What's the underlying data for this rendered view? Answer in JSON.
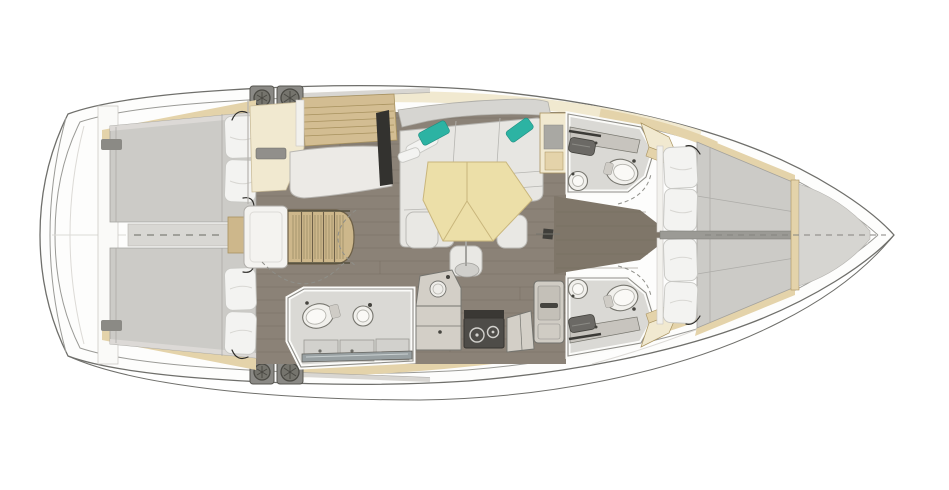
{
  "scene": {
    "label": "sailing-yacht-interior-floor-plan",
    "view": "top-down",
    "bow_direction": "right",
    "background": "#ffffff"
  },
  "colors": {
    "hull_line": "#6f6f6b",
    "hull_inner": "#9a9a96",
    "floor": "#8b8277",
    "floor_seam": "#746c61",
    "corridor": "#7f7669",
    "walkway": "#d8d7d3",
    "mattress": "#cccbc7",
    "mattress_seam": "#adaca8",
    "pillow": "#f3f3f1",
    "pillow_line": "#c8c8c4",
    "wood": "#e4d3aa",
    "wood_dark": "#cdb78b",
    "cream": "#f1e9d0",
    "table_wood": "#ecdfa8",
    "table_seam": "#c9b67c",
    "sofa": "#e7e6e2",
    "sofa_back": "#d6d5d1",
    "sofa_seam": "#b7b6b2",
    "teal": "#2cb3a3",
    "counter": "#d3cfc7",
    "counter_line": "#74746f",
    "stove": "#4e4c48",
    "stove_dark": "#363430",
    "head_floor": "#dad9d5",
    "fixture": "#f1f0ec",
    "fixture_line": "#77766f",
    "sink_dark": "#6b6965",
    "glass": "#98a0a2",
    "plate": "#8a8985",
    "plate_dark": "#56554f",
    "tv_dark": "#33322f",
    "dash": "#8f8f89",
    "white_wall": "#fafaf8"
  },
  "layout_summary": {
    "cabins": 4,
    "heads": 3,
    "salon_tables": 1,
    "winches": 4
  },
  "rooms": [
    {
      "id": "aft-deck",
      "label": "Aft deck / transom",
      "furniture": [
        "rounded transom platform",
        "centerline"
      ]
    },
    {
      "id": "aft-cabin-port",
      "label": "Aft cabin (port)",
      "furniture": [
        "double berth",
        "two pillows",
        "hull shelf",
        "reading light",
        "vent"
      ]
    },
    {
      "id": "aft-cabin-starboard",
      "label": "Aft cabin (starboard)",
      "furniture": [
        "double berth",
        "two pillows",
        "hull shelf",
        "reading light",
        "vent"
      ]
    },
    {
      "id": "companionway",
      "label": "Companionway",
      "furniture": [
        "wooden steps",
        "engine box",
        "walkway between aft berths"
      ]
    },
    {
      "id": "nav-station",
      "label": "Nav station (port)",
      "furniture": [
        "chart table",
        "nav seat",
        "instrument locker",
        "tv screen",
        "vent"
      ]
    },
    {
      "id": "saloon",
      "label": "Saloon (port)",
      "furniture": [
        "l-shaped sofa",
        "white bolster",
        "teal throw pillow left",
        "teal throw pillow right",
        "folding hexagonal table",
        "three stools",
        "table pedestal",
        "end cabinet"
      ]
    },
    {
      "id": "galley",
      "label": "Galley (starboard)",
      "furniture": [
        "round sink unit",
        "lower counter",
        "two-burner stove",
        "side counter",
        "refrigerator"
      ]
    },
    {
      "id": "day-head",
      "label": "Day head with shower (starboard)",
      "furniture": [
        "toilet",
        "round washbasin",
        "shower pans",
        "glass shower screen"
      ]
    },
    {
      "id": "head-forward-port",
      "label": "Forward head (port)",
      "furniture": [
        "vanity counter",
        "rectangular sink",
        "towel rail",
        "toilet",
        "round washbasin"
      ]
    },
    {
      "id": "head-forward-starboard",
      "label": "Forward head (starboard)",
      "furniture": [
        "vanity counter",
        "rectangular sink",
        "towel rail",
        "toilet",
        "round washbasin"
      ]
    },
    {
      "id": "forward-cabin-port",
      "label": "Forward cabin (port)",
      "furniture": [
        "berth mattress",
        "two pillows",
        "wardrobe",
        "hull trim"
      ]
    },
    {
      "id": "forward-cabin-starboard",
      "label": "Forward cabin (starboard)",
      "furniture": [
        "berth mattress",
        "two pillows",
        "wardrobe",
        "hull trim"
      ]
    },
    {
      "id": "bow-locker",
      "label": "Bow sail locker",
      "furniture": [
        "forepeak panel",
        "dashed centerline"
      ]
    },
    {
      "id": "deck",
      "label": "Side decks",
      "furniture": [
        "winch plates port",
        "winch plates starboard",
        "genoa tracks",
        "mast post"
      ]
    }
  ]
}
